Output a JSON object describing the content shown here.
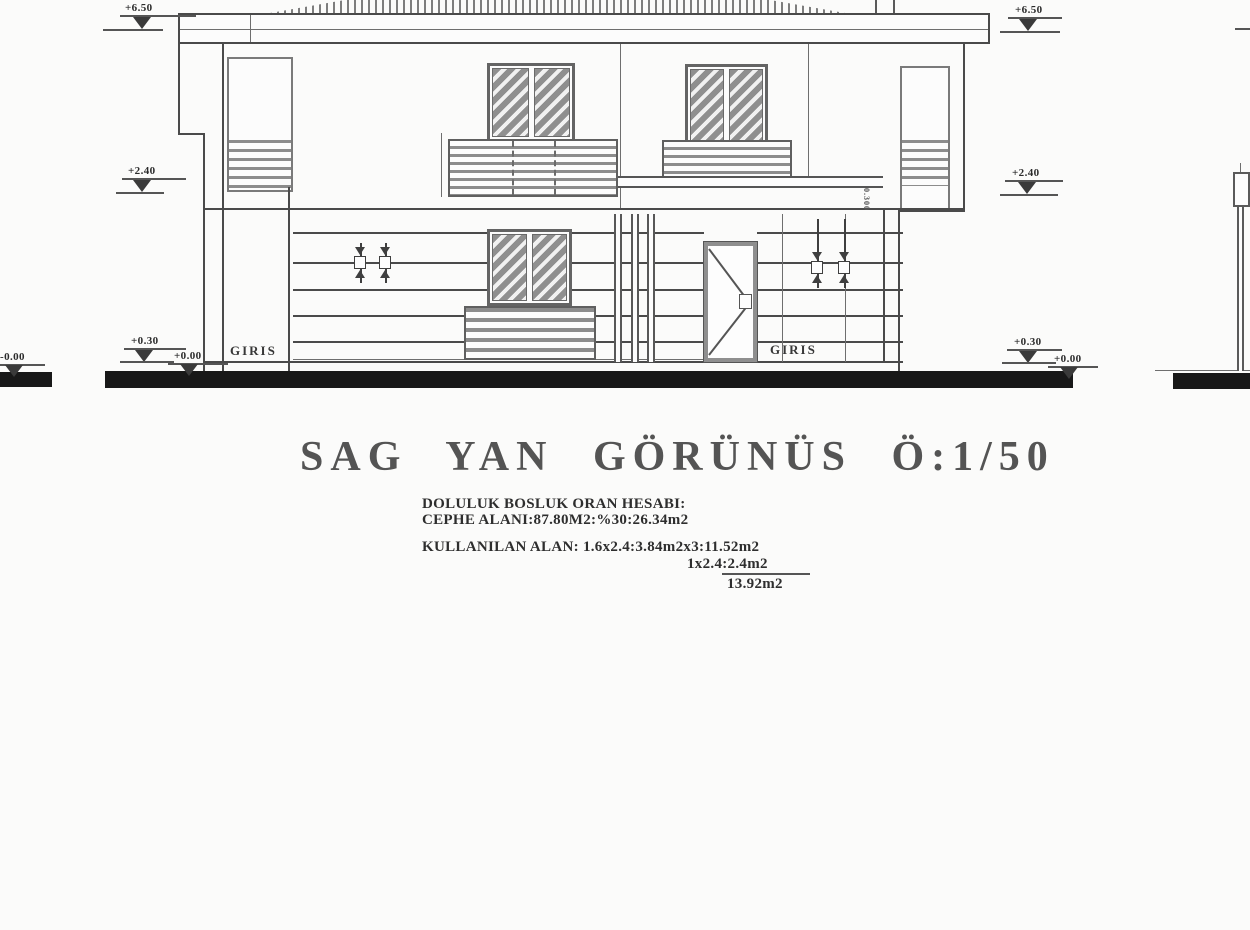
{
  "title": "SAG YAN GÖRÜNÜS Ö:1/50",
  "labels": {
    "entrance_left": "GIRIS",
    "entrance_right": "GIRIS",
    "vertical_dim": "0.300"
  },
  "calculations": {
    "heading": "DOLULUK BOSLUK ORAN HESABI:",
    "facade_area": "CEPHE ALANI:87.80M2:%30:26.34m2",
    "used_area": "KULLANILAN ALAN: 1.6x2.4:3.84m2x3:11.52m2",
    "used_area_2": "1x2.4:2.4m2",
    "total": "13.92m2"
  },
  "elevation_markers": {
    "left_roof": "+6.50",
    "right_roof": "+6.50",
    "left_floor": "+2.40",
    "right_floor": "+2.40",
    "left_entrance": "+0.30",
    "right_entrance": "+0.30",
    "left_ground": "+0.00",
    "right_ground": "+0.00",
    "far_left_ground": "-0.00"
  },
  "colors": {
    "paper": "#fbfbfa",
    "line": "#4a4a4a",
    "ground_bar": "#181818",
    "hatch": "#8f8f8f"
  }
}
